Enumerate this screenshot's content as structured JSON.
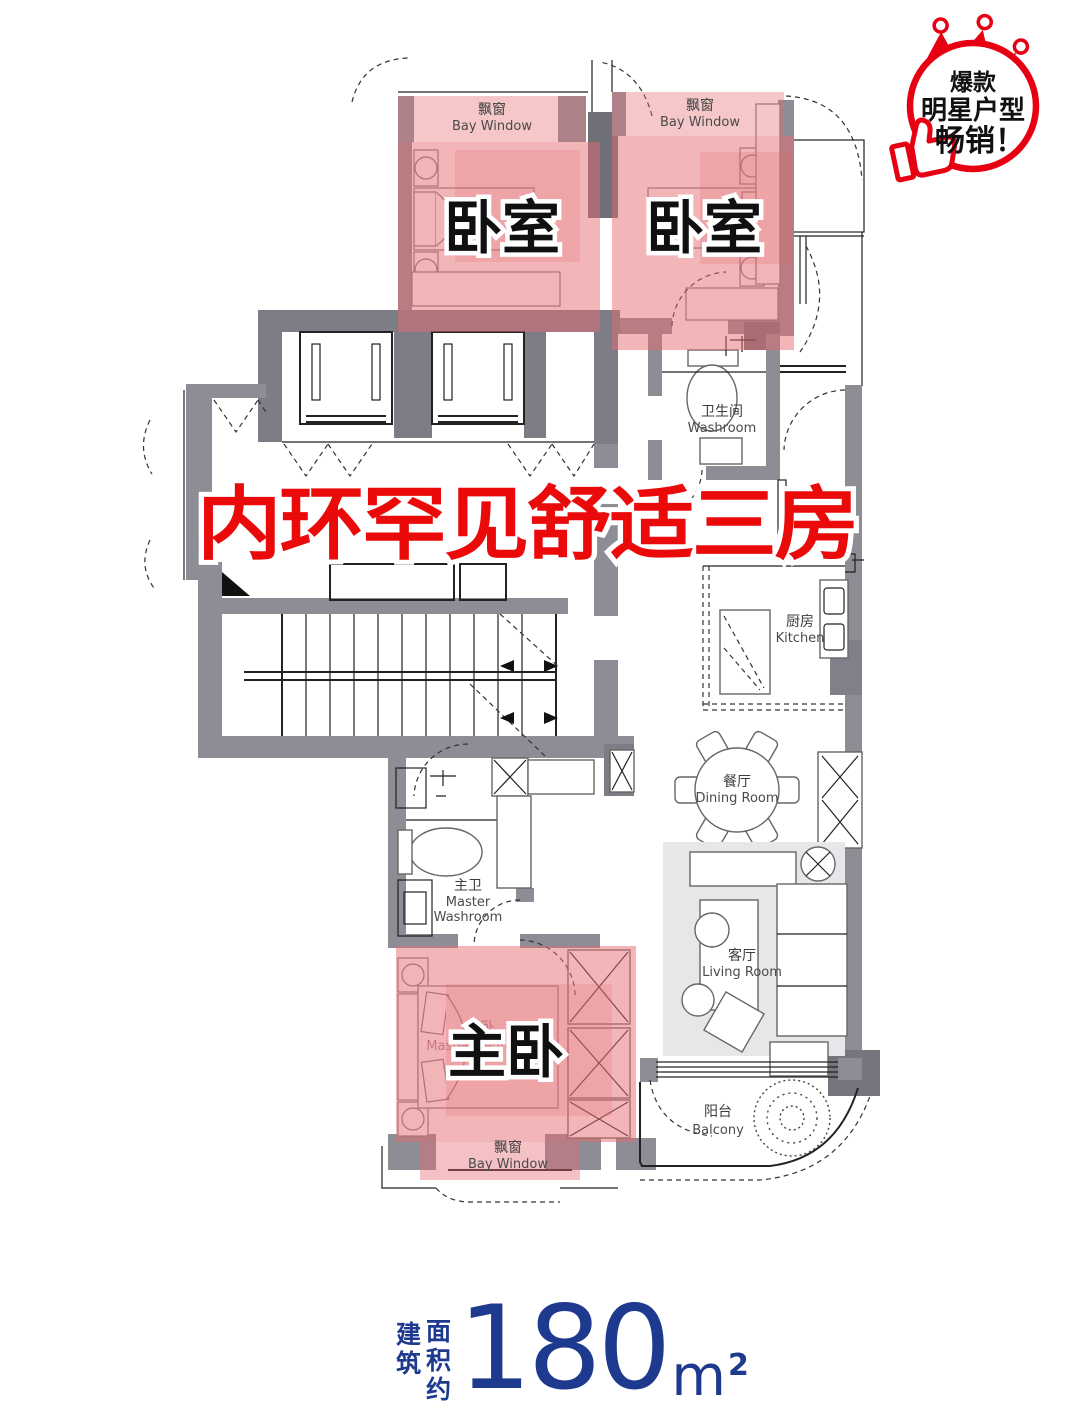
{
  "badge": {
    "line1": "爆款",
    "line2": "明星户型",
    "line3": "畅销！"
  },
  "headline": {
    "text": "内环罕见舒适三房"
  },
  "labels": {
    "bay_window_top_left": {
      "cn": "飘窗",
      "en": "Bay Window"
    },
    "bay_window_top_right": {
      "cn": "飘窗",
      "en": "Bay Window"
    },
    "bay_window_bottom": {
      "cn": "飘窗",
      "en": "Bay Window"
    },
    "bedroom1": {
      "big": "卧室"
    },
    "bedroom2": {
      "big": "卧室"
    },
    "master_bedroom": {
      "big": "主卧",
      "cn": "主卧",
      "en": "Master Bedroom"
    },
    "washroom": {
      "cn": "卫生间",
      "en": "Washroom"
    },
    "master_washroom": {
      "cn": "主卫",
      "en1": "Master",
      "en2": "Washroom"
    },
    "kitchen": {
      "cn": "厨房",
      "en": "Kitchen"
    },
    "dining_room": {
      "cn": "餐厅",
      "en": "Dining Room"
    },
    "living_room": {
      "cn": "客厅",
      "en": "Living Room"
    },
    "balcony": {
      "cn": "阳台",
      "en": "Balcony"
    }
  },
  "area": {
    "prefix_left": "建筑",
    "prefix_right": "面积约",
    "value": "180",
    "unit": "m",
    "sup": "2"
  },
  "colors": {
    "accent_red": "#ea0a0a",
    "badge_red": "#e60012",
    "highlight_pink": "#e56b72",
    "area_blue": "#1e3a8f",
    "wall_gray": "#8d8d95",
    "core_gray": "#7d7d86"
  }
}
